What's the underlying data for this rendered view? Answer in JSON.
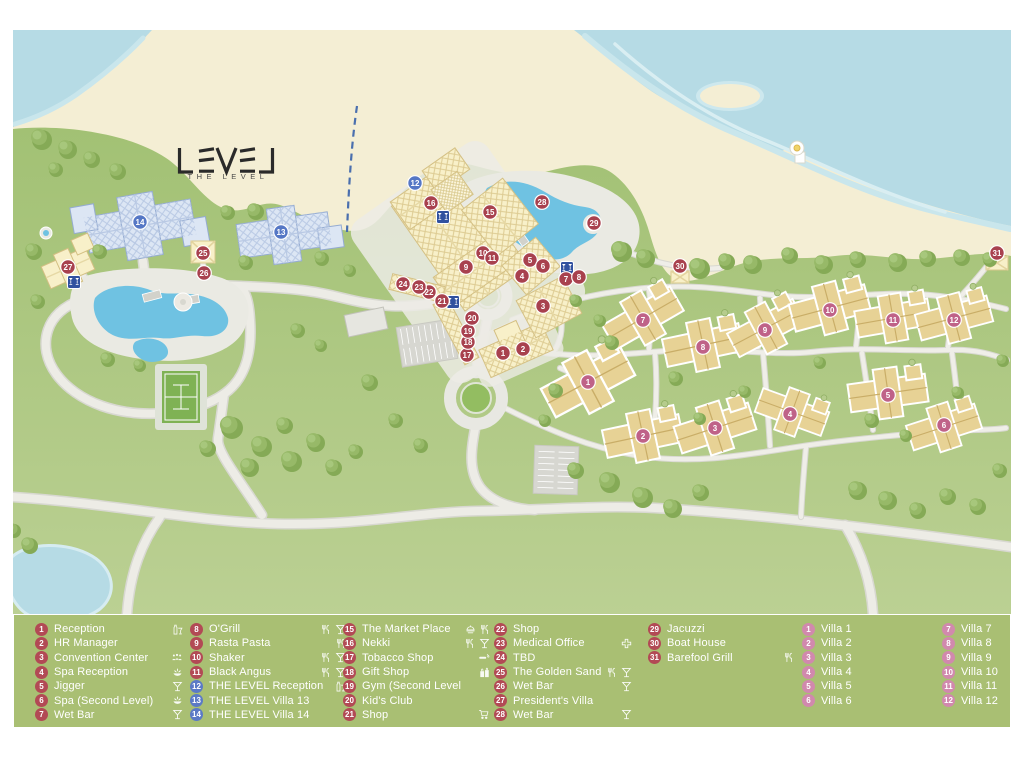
{
  "logo": {
    "word": "LEVEL",
    "subtitle": "THE LEVEL"
  },
  "colors": {
    "marker_red": "#a8414e",
    "marker_blue": "#5577c5",
    "marker_villa_map": "#bf6288",
    "legend_chip_red": "#b24a55",
    "legend_chip_blue": "#5b7ac6",
    "legend_chip_pink": "#d189ad",
    "legend_bg": "#a9bf73",
    "water": "#b6dbe5",
    "sand": "#f4eed4",
    "pool": "#6fc2e2",
    "building_yellow": "#f8f0c9",
    "building_blue": "#dce6f4",
    "villa_tan": "#e7d295",
    "wet_bar_blue": "#31519f"
  },
  "legend": {
    "columns": [
      {
        "items": [
          {
            "num": "1",
            "color": "red",
            "label": "Reception",
            "icons": [
              "drinks"
            ]
          },
          {
            "num": "2",
            "color": "red",
            "label": "HR Manager",
            "icons": []
          },
          {
            "num": "3",
            "color": "red",
            "label": "Convention Center",
            "icons": [
              "people"
            ]
          },
          {
            "num": "4",
            "color": "red",
            "label": "Spa Reception",
            "icons": [
              "spa"
            ]
          },
          {
            "num": "5",
            "color": "red",
            "label": "Jigger",
            "icons": [
              "bar"
            ]
          },
          {
            "num": "6",
            "color": "red",
            "label": "Spa (Second Level)",
            "icons": [
              "spa"
            ]
          },
          {
            "num": "7",
            "color": "red",
            "label": "Wet Bar",
            "icons": [
              "bar"
            ]
          }
        ]
      },
      {
        "items": [
          {
            "num": "8",
            "color": "red",
            "label": "O'Grill",
            "icons": [
              "restaurant",
              "bar"
            ]
          },
          {
            "num": "9",
            "color": "red",
            "label": "Rasta Pasta",
            "icons": [
              "restaurant"
            ]
          },
          {
            "num": "10",
            "color": "red",
            "label": "Shaker",
            "icons": [
              "restaurant",
              "bar"
            ]
          },
          {
            "num": "11",
            "color": "red",
            "label": "Black Angus",
            "icons": [
              "restaurant",
              "bar"
            ]
          },
          {
            "num": "12",
            "color": "blue",
            "label": "THE LEVEL Reception",
            "icons": [
              "drinks"
            ]
          },
          {
            "num": "13",
            "color": "blue",
            "label": "THE LEVEL Villa 13",
            "icons": []
          },
          {
            "num": "14",
            "color": "blue",
            "label": "THE LEVEL Villa 14",
            "icons": []
          }
        ]
      },
      {
        "items": [
          {
            "num": "15",
            "color": "red",
            "label": "The Market Place",
            "icons": [
              "buffet",
              "restaurant"
            ]
          },
          {
            "num": "16",
            "color": "red",
            "label": "Nekki",
            "icons": [
              "restaurant",
              "bar"
            ]
          },
          {
            "num": "17",
            "color": "red",
            "label": "Tobacco Shop",
            "icons": [
              "cigar"
            ]
          },
          {
            "num": "18",
            "color": "red",
            "label": "Gift Shop",
            "icons": [
              "gift"
            ]
          },
          {
            "num": "19",
            "color": "red",
            "label": "Gym (Second Level",
            "icons": []
          },
          {
            "num": "20",
            "color": "red",
            "label": "Kid's Club",
            "icons": []
          },
          {
            "num": "21",
            "color": "red",
            "label": "Shop",
            "icons": [
              "cart"
            ]
          }
        ]
      },
      {
        "items": [
          {
            "num": "22",
            "color": "red",
            "label": "Shop",
            "icons": []
          },
          {
            "num": "23",
            "color": "red",
            "label": "Medical Office",
            "icons": [
              "medical"
            ]
          },
          {
            "num": "24",
            "color": "red",
            "label": "TBD",
            "icons": []
          },
          {
            "num": "25",
            "color": "red",
            "label": "The Golden Sand",
            "icons": [
              "restaurant",
              "bar"
            ]
          },
          {
            "num": "26",
            "color": "red",
            "label": "Wet Bar",
            "icons": [
              "bar"
            ]
          },
          {
            "num": "27",
            "color": "red",
            "label": "President's Villa",
            "icons": []
          },
          {
            "num": "28",
            "color": "red",
            "label": "Wet Bar",
            "icons": [
              "bar"
            ]
          }
        ]
      },
      {
        "items": [
          {
            "num": "29",
            "color": "red",
            "label": "Jacuzzi",
            "icons": []
          },
          {
            "num": "30",
            "color": "red",
            "label": "Boat House",
            "icons": []
          },
          {
            "num": "31",
            "color": "red",
            "label": "Barefool Grill",
            "icons": [
              "restaurant"
            ]
          }
        ]
      },
      {
        "items": [
          {
            "num": "1",
            "color": "pink",
            "label": "Villa 1",
            "icons": []
          },
          {
            "num": "2",
            "color": "pink",
            "label": "Villa 2",
            "icons": []
          },
          {
            "num": "3",
            "color": "pink",
            "label": "Villa 3",
            "icons": []
          },
          {
            "num": "4",
            "color": "pink",
            "label": "Villa 4",
            "icons": []
          },
          {
            "num": "5",
            "color": "pink",
            "label": "Villa 5",
            "icons": []
          },
          {
            "num": "6",
            "color": "pink",
            "label": "Villa 6",
            "icons": []
          }
        ]
      },
      {
        "items": [
          {
            "num": "7",
            "color": "pink",
            "label": "Villa 7",
            "icons": []
          },
          {
            "num": "8",
            "color": "pink",
            "label": "Villa 8",
            "icons": []
          },
          {
            "num": "9",
            "color": "pink",
            "label": "Villa 9",
            "icons": []
          },
          {
            "num": "10",
            "color": "pink",
            "label": "Villa 10",
            "icons": []
          },
          {
            "num": "11",
            "color": "pink",
            "label": "Villa 11",
            "icons": []
          },
          {
            "num": "12",
            "color": "pink",
            "label": "Villa 12",
            "icons": []
          }
        ]
      }
    ]
  },
  "map": {
    "markers": [
      {
        "num": "1",
        "type": "service",
        "x": 503,
        "y": 353
      },
      {
        "num": "2",
        "type": "service",
        "x": 523,
        "y": 349
      },
      {
        "num": "3",
        "type": "service",
        "x": 543,
        "y": 306
      },
      {
        "num": "4",
        "type": "service",
        "x": 522,
        "y": 276
      },
      {
        "num": "5",
        "type": "service",
        "x": 530,
        "y": 260
      },
      {
        "num": "6",
        "type": "service",
        "x": 543,
        "y": 266
      },
      {
        "num": "7",
        "type": "service",
        "x": 566,
        "y": 279
      },
      {
        "num": "8",
        "type": "service",
        "x": 579,
        "y": 277
      },
      {
        "num": "9",
        "type": "service",
        "x": 466,
        "y": 267
      },
      {
        "num": "10",
        "type": "service",
        "x": 483,
        "y": 253
      },
      {
        "num": "11",
        "type": "service",
        "x": 492,
        "y": 258
      },
      {
        "num": "12",
        "type": "level",
        "x": 415,
        "y": 183
      },
      {
        "num": "13",
        "type": "level",
        "x": 281,
        "y": 232
      },
      {
        "num": "14",
        "type": "level",
        "x": 140,
        "y": 222
      },
      {
        "num": "15",
        "type": "service",
        "x": 490,
        "y": 212
      },
      {
        "num": "16",
        "type": "service",
        "x": 431,
        "y": 203
      },
      {
        "num": "17",
        "type": "service",
        "x": 467,
        "y": 355
      },
      {
        "num": "18",
        "type": "service",
        "x": 468,
        "y": 342
      },
      {
        "num": "19",
        "type": "service",
        "x": 468,
        "y": 331
      },
      {
        "num": "20",
        "type": "service",
        "x": 472,
        "y": 318
      },
      {
        "num": "21",
        "type": "service",
        "x": 442,
        "y": 301
      },
      {
        "num": "22",
        "type": "service",
        "x": 429,
        "y": 292
      },
      {
        "num": "23",
        "type": "service",
        "x": 419,
        "y": 287
      },
      {
        "num": "24",
        "type": "service",
        "x": 403,
        "y": 284
      },
      {
        "num": "25",
        "type": "service",
        "x": 203,
        "y": 253
      },
      {
        "num": "26",
        "type": "service",
        "x": 204,
        "y": 273
      },
      {
        "num": "27",
        "type": "service",
        "x": 68,
        "y": 267
      },
      {
        "num": "28",
        "type": "service",
        "x": 542,
        "y": 202
      },
      {
        "num": "29",
        "type": "service",
        "x": 594,
        "y": 223
      },
      {
        "num": "30",
        "type": "service",
        "x": 680,
        "y": 266
      },
      {
        "num": "31",
        "type": "service",
        "x": 997,
        "y": 253
      },
      {
        "num": "1",
        "type": "villa",
        "x": 588,
        "y": 382
      },
      {
        "num": "2",
        "type": "villa",
        "x": 643,
        "y": 436
      },
      {
        "num": "3",
        "type": "villa",
        "x": 715,
        "y": 428
      },
      {
        "num": "4",
        "type": "villa",
        "x": 790,
        "y": 414
      },
      {
        "num": "5",
        "type": "villa",
        "x": 888,
        "y": 395
      },
      {
        "num": "6",
        "type": "villa",
        "x": 944,
        "y": 425
      },
      {
        "num": "7",
        "type": "villa",
        "x": 643,
        "y": 320
      },
      {
        "num": "8",
        "type": "villa",
        "x": 703,
        "y": 347
      },
      {
        "num": "9",
        "type": "villa",
        "x": 765,
        "y": 330
      },
      {
        "num": "10",
        "type": "villa",
        "x": 830,
        "y": 310
      },
      {
        "num": "11",
        "type": "villa",
        "x": 893,
        "y": 320
      },
      {
        "num": "12",
        "type": "villa",
        "x": 954,
        "y": 320
      }
    ],
    "wet_bar_icons": [
      {
        "x": 74,
        "y": 282
      },
      {
        "x": 443,
        "y": 217
      },
      {
        "x": 453,
        "y": 302
      },
      {
        "x": 567,
        "y": 268
      }
    ]
  }
}
